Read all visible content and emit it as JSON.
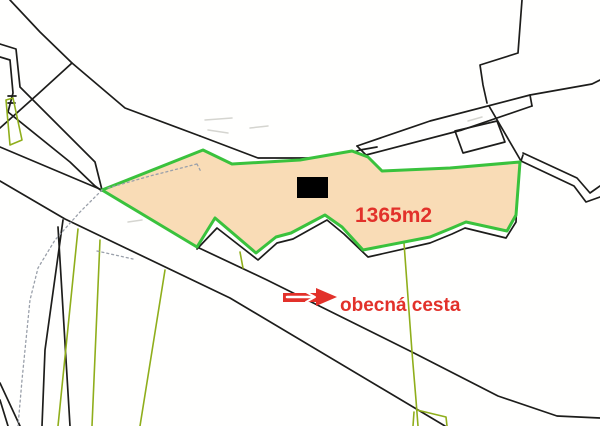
{
  "labels": {
    "area": "1365m2",
    "road": "obecná cesta"
  },
  "colors": {
    "background": "#fffffe",
    "parcel_fill": "#f9dcb6",
    "parcel_border": "#3ac23d",
    "field_line": "#8fae1b",
    "boundary": "#1d1d1b",
    "red": "#e2312a",
    "dotted": "#9aa0aa",
    "faint": "#d5d5d0",
    "building": "#000000",
    "white": "#ffffff"
  },
  "shapes": {
    "parcel_polygon": [
      [
        102,
        190
      ],
      [
        203,
        150
      ],
      [
        232,
        164
      ],
      [
        300,
        160
      ],
      [
        352,
        151
      ],
      [
        368,
        157
      ],
      [
        382,
        171
      ],
      [
        450,
        168
      ],
      [
        520,
        162
      ],
      [
        516,
        215
      ],
      [
        507,
        231
      ],
      [
        466,
        222
      ],
      [
        452,
        228
      ],
      [
        430,
        237
      ],
      [
        363,
        250
      ],
      [
        342,
        227
      ],
      [
        325,
        215
      ],
      [
        291,
        233
      ],
      [
        276,
        237
      ],
      [
        256,
        253
      ],
      [
        215,
        218
      ],
      [
        197,
        247
      ]
    ],
    "building_rect": {
      "x": 297,
      "y": 177,
      "w": 31,
      "h": 21
    },
    "black_polylines": [
      [
        [
          10,
          0
        ],
        [
          40,
          32
        ],
        [
          72,
          63
        ],
        [
          125,
          108
        ],
        [
          200,
          136
        ]
      ],
      [
        [
          72,
          63
        ],
        [
          38,
          94
        ],
        [
          0,
          128
        ]
      ],
      [
        [
          200,
          136
        ],
        [
          258,
          158
        ],
        [
          335,
          158
        ],
        [
          360,
          150
        ],
        [
          377,
          147
        ]
      ],
      [
        [
          0,
          44
        ],
        [
          16,
          49
        ],
        [
          20,
          87
        ],
        [
          95,
          162
        ],
        [
          102,
          190
        ]
      ],
      [
        [
          0,
          57
        ],
        [
          10,
          60
        ],
        [
          13,
          93
        ],
        [
          8,
          112
        ],
        [
          70,
          162
        ],
        [
          95,
          186
        ],
        [
          102,
          191
        ]
      ],
      [
        [
          8,
          96
        ],
        [
          16,
          96
        ]
      ],
      [
        [
          8,
          103
        ],
        [
          15,
          103
        ]
      ],
      [
        [
          357,
          146
        ],
        [
          430,
          121
        ],
        [
          530,
          95
        ],
        [
          592,
          84
        ],
        [
          600,
          80
        ]
      ],
      [
        [
          366,
          155
        ],
        [
          462,
          130
        ],
        [
          532,
          106
        ]
      ],
      [
        [
          357,
          146
        ],
        [
          366,
          155
        ]
      ],
      [
        [
          530,
          95
        ],
        [
          532,
          106
        ]
      ],
      [
        [
          522,
          0
        ],
        [
          518,
          53
        ],
        [
          480,
          65
        ],
        [
          483,
          85
        ],
        [
          487,
          103
        ]
      ],
      [
        [
          489,
          106
        ],
        [
          521,
          161
        ]
      ],
      [
        [
          455,
          131
        ],
        [
          497,
          121
        ],
        [
          505,
          142
        ],
        [
          463,
          153
        ],
        [
          455,
          131
        ]
      ],
      [
        [
          523,
          153
        ],
        [
          577,
          178
        ],
        [
          590,
          193
        ],
        [
          600,
          186
        ]
      ],
      [
        [
          521,
          161
        ],
        [
          574,
          186
        ],
        [
          586,
          202
        ],
        [
          600,
          197
        ]
      ],
      [
        [
          197,
          249
        ],
        [
          217,
          228
        ],
        [
          258,
          260
        ],
        [
          277,
          243
        ],
        [
          293,
          239
        ],
        [
          327,
          220
        ],
        [
          344,
          234
        ],
        [
          368,
          257
        ],
        [
          430,
          243
        ],
        [
          452,
          234
        ],
        [
          465,
          228
        ],
        [
          506,
          238
        ],
        [
          516,
          222
        ],
        [
          518,
          170
        ],
        [
          523,
          155
        ]
      ],
      [
        [
          0,
          147
        ],
        [
          102,
          190
        ],
        [
          197,
          247
        ],
        [
          267,
          280
        ],
        [
          412,
          352
        ],
        [
          498,
          396
        ],
        [
          557,
          416
        ],
        [
          600,
          418
        ]
      ],
      [
        [
          0,
          181
        ],
        [
          65,
          219
        ],
        [
          230,
          298
        ],
        [
          445,
          426
        ]
      ],
      [
        [
          63,
          220
        ],
        [
          45,
          350
        ],
        [
          42,
          426
        ]
      ],
      [
        [
          58,
          227
        ],
        [
          70,
          426
        ]
      ],
      [
        [
          0,
          383
        ],
        [
          20,
          426
        ]
      ],
      [
        [
          0,
          400
        ],
        [
          8,
          426
        ]
      ]
    ],
    "green_polylines": [
      [
        [
          78,
          229
        ],
        [
          58,
          426
        ]
      ],
      [
        [
          100,
          240
        ],
        [
          92,
          426
        ]
      ],
      [
        [
          165,
          270
        ],
        [
          140,
          426
        ]
      ],
      [
        [
          6,
          100
        ],
        [
          13,
          98
        ],
        [
          22,
          140
        ],
        [
          10,
          145
        ],
        [
          6,
          100
        ]
      ],
      [
        [
          404,
          243
        ],
        [
          412,
          352
        ],
        [
          416,
          400
        ],
        [
          418,
          426
        ]
      ],
      [
        [
          417,
          410
        ],
        [
          446,
          417
        ],
        [
          447,
          426
        ]
      ],
      [
        [
          414,
          412
        ],
        [
          413,
          426
        ]
      ],
      [
        [
          240,
          252
        ],
        [
          243,
          268
        ]
      ]
    ],
    "dotted_polylines": [
      [
        [
          102,
          190
        ],
        [
          80,
          212
        ],
        [
          55,
          240
        ],
        [
          38,
          268
        ],
        [
          30,
          300
        ],
        [
          26,
          340
        ],
        [
          22,
          380
        ],
        [
          18,
          426
        ]
      ],
      [
        [
          108,
          188
        ],
        [
          150,
          176
        ],
        [
          197,
          164
        ]
      ],
      [
        [
          197,
          164
        ],
        [
          201,
          172
        ]
      ],
      [
        [
          97,
          251
        ],
        [
          133,
          259
        ]
      ]
    ],
    "faint_polylines": [
      [
        [
          205,
          120
        ],
        [
          232,
          118
        ]
      ],
      [
        [
          208,
          130
        ],
        [
          228,
          133
        ]
      ],
      [
        [
          250,
          128
        ],
        [
          268,
          126
        ]
      ],
      [
        [
          468,
          121
        ],
        [
          482,
          117
        ]
      ],
      [
        [
          128,
          222
        ],
        [
          142,
          220
        ]
      ]
    ]
  },
  "arrow": {
    "head": [
      [
        316,
        288
      ],
      [
        337,
        297
      ],
      [
        316,
        306
      ]
    ],
    "shaft": [
      [
        283,
        293
      ],
      [
        318,
        293
      ],
      [
        318,
        302
      ],
      [
        283,
        302
      ]
    ],
    "slit": [
      [
        287,
        297
      ],
      [
        312,
        297
      ]
    ],
    "chevron": [
      [
        306,
        292
      ],
      [
        315,
        297
      ],
      [
        306,
        302
      ]
    ]
  }
}
